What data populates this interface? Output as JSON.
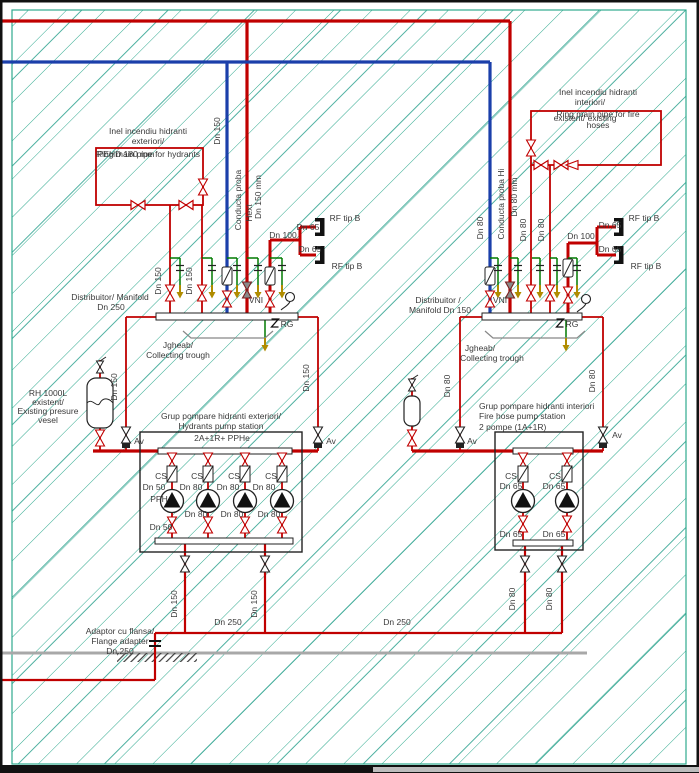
{
  "drawing": {
    "type": "fire-protection-piping-schematic",
    "colors": {
      "pipe_red": "#c00000",
      "pipe_blue": "#1b3faa",
      "hatch_teal": "#2fa98e",
      "drain_green": "#007a00",
      "arrow_olive": "#b08c00",
      "wall_gray": "#a8a8a8",
      "symbol_black": "#222222",
      "text": "#3a3a3a"
    },
    "labels": [
      {
        "n": "ring-ext-title-ro",
        "t": "Inel incendiu hidranti",
        "x": 148,
        "y": 134
      },
      {
        "n": "ring-ext-title-ro2",
        "t": "exteriori/",
        "x": 148,
        "y": 144
      },
      {
        "n": "ring-ext-pehd",
        "t": "PEHD 180 mm",
        "x": 126,
        "y": 157
      },
      {
        "n": "ring-ext-title-en",
        "t": "Ring main pipe for hydrants",
        "x": 148,
        "y": 157
      },
      {
        "n": "dn150-blue-left",
        "t": "Dn 150",
        "x": 220,
        "y": 131,
        "r": -90
      },
      {
        "n": "conducta-proba-left",
        "t": "Conducta proba",
        "x": 241,
        "y": 200,
        "r": -90
      },
      {
        "n": "conducta-proba-left2",
        "t": "Hext",
        "x": 252,
        "y": 213,
        "r": -90
      },
      {
        "n": "dn150mm-left",
        "t": "Dn 150 mm",
        "x": 261,
        "y": 197,
        "r": -90
      },
      {
        "n": "dn100-left",
        "t": "Dn 100",
        "x": 283,
        "y": 238
      },
      {
        "n": "dn65-left-1",
        "t": "Dn 65",
        "x": 308,
        "y": 230
      },
      {
        "n": "rf-left-1",
        "t": "RF tip B",
        "x": 345,
        "y": 221
      },
      {
        "n": "dn65-left-2",
        "t": "Dn 65",
        "x": 310,
        "y": 252
      },
      {
        "n": "rf-left-2",
        "t": "RF tip B",
        "x": 347,
        "y": 269
      },
      {
        "n": "dn150-riser1",
        "t": "Dn 150",
        "x": 161,
        "y": 281,
        "r": -90
      },
      {
        "n": "dn150-riser2",
        "t": "Dn 150",
        "x": 192,
        "y": 281,
        "r": -90
      },
      {
        "n": "manifold-left-1",
        "t": "Distribuitor/ Manifold",
        "x": 110,
        "y": 300
      },
      {
        "n": "manifold-left-2",
        "t": "Dn 250",
        "x": 111,
        "y": 310
      },
      {
        "n": "vni-left",
        "t": "VNI",
        "x": 256,
        "y": 303
      },
      {
        "n": "rg-left",
        "t": "RG",
        "x": 287,
        "y": 327
      },
      {
        "n": "trough-left-ro",
        "t": "Jgheab/",
        "x": 178,
        "y": 348
      },
      {
        "n": "trough-left-en",
        "t": "Collecting trough",
        "x": 178,
        "y": 358
      },
      {
        "n": "vessel-1",
        "t": "RH 1000L",
        "x": 48,
        "y": 396
      },
      {
        "n": "vessel-2",
        "t": "existent/",
        "x": 48,
        "y": 405
      },
      {
        "n": "vessel-3",
        "t": "Existing presure",
        "x": 48,
        "y": 414
      },
      {
        "n": "vessel-4",
        "t": "vesel",
        "x": 48,
        "y": 423
      },
      {
        "n": "dn150-vessel",
        "t": "Dn 150",
        "x": 117,
        "y": 387,
        "r": -90
      },
      {
        "n": "av-1",
        "t": "Av",
        "x": 139,
        "y": 444
      },
      {
        "n": "dn150-right-drop",
        "t": "Dn 150",
        "x": 309,
        "y": 378,
        "r": -90
      },
      {
        "n": "av-2",
        "t": "Av",
        "x": 331,
        "y": 444
      },
      {
        "n": "pump-left-title1",
        "t": "Grup pompare hidranti exteriori/",
        "x": 221,
        "y": 419
      },
      {
        "n": "pump-left-title2",
        "t": "Hydrants pump station",
        "x": 221,
        "y": 429
      },
      {
        "n": "pump-left-title3",
        "t": "2A+1R+ PPHe",
        "x": 222,
        "y": 441
      },
      {
        "n": "cs-1",
        "t": "CS",
        "x": 161,
        "y": 479
      },
      {
        "n": "cs-2",
        "t": "CS",
        "x": 197,
        "y": 479
      },
      {
        "n": "cs-3",
        "t": "CS",
        "x": 234,
        "y": 479
      },
      {
        "n": "cs-4",
        "t": "CS",
        "x": 271,
        "y": 479
      },
      {
        "n": "dn50-1",
        "t": "Dn 50",
        "x": 154,
        "y": 490
      },
      {
        "n": "dn80-1",
        "t": "Dn 80",
        "x": 191,
        "y": 490
      },
      {
        "n": "dn80-2",
        "t": "Dn 80",
        "x": 228,
        "y": 490
      },
      {
        "n": "dn80-3",
        "t": "Dn 80",
        "x": 264,
        "y": 490
      },
      {
        "n": "pph",
        "t": "PPH",
        "x": 159,
        "y": 502
      },
      {
        "n": "dn80-4",
        "t": "Dn 80",
        "x": 196,
        "y": 517
      },
      {
        "n": "dn80-5",
        "t": "Dn 80",
        "x": 232,
        "y": 517
      },
      {
        "n": "dn80-6",
        "t": "Dn 80",
        "x": 269,
        "y": 517
      },
      {
        "n": "dn50-2",
        "t": "Dn 50",
        "x": 161,
        "y": 530
      },
      {
        "n": "dn150-bottom1",
        "t": "Dn 150",
        "x": 177,
        "y": 604,
        "r": -90
      },
      {
        "n": "dn150-bottom2",
        "t": "Dn 150",
        "x": 257,
        "y": 604,
        "r": -90
      },
      {
        "n": "dn250-bottom1",
        "t": "Dn 250",
        "x": 228,
        "y": 625
      },
      {
        "n": "dn250-bottom2",
        "t": "Dn 250",
        "x": 397,
        "y": 625
      },
      {
        "n": "flange-1",
        "t": "Adaptor cu flansa/",
        "x": 120,
        "y": 634
      },
      {
        "n": "flange-2",
        "t": "Flange adapter",
        "x": 120,
        "y": 644
      },
      {
        "n": "flange-3",
        "t": "Dn 250",
        "x": 120,
        "y": 654
      },
      {
        "n": "ring-int-1",
        "t": "Inel incendiu hidranti",
        "x": 598,
        "y": 95
      },
      {
        "n": "ring-int-2",
        "t": "interiori/",
        "x": 590,
        "y": 105
      },
      {
        "n": "ring-int-3",
        "t": "Ring main pipe for fire",
        "x": 598,
        "y": 117
      },
      {
        "n": "ring-int-4",
        "t": "existent/ existing",
        "x": 585,
        "y": 121
      },
      {
        "n": "ring-int-5",
        "t": "hoses",
        "x": 598,
        "y": 128
      },
      {
        "n": "dn80-blue-right",
        "t": "Dn 80",
        "x": 483,
        "y": 228,
        "r": -90
      },
      {
        "n": "conducta-proba-right",
        "t": "Conducta proba Hi",
        "x": 504,
        "y": 204,
        "r": -90
      },
      {
        "n": "dn80mm-right",
        "t": "Dn 80 mm",
        "x": 517,
        "y": 197,
        "r": -90
      },
      {
        "n": "dn80-riser1",
        "t": "Dn 80",
        "x": 526,
        "y": 230,
        "r": -90
      },
      {
        "n": "dn80-riser2",
        "t": "Dn 80",
        "x": 544,
        "y": 230,
        "r": -90
      },
      {
        "n": "dn100-right",
        "t": "Dn 100",
        "x": 581,
        "y": 239
      },
      {
        "n": "dn65-right-1",
        "t": "Dn 65",
        "x": 610,
        "y": 228
      },
      {
        "n": "rf-right-1",
        "t": "RF tip B",
        "x": 644,
        "y": 221
      },
      {
        "n": "dn65-right-2",
        "t": "Dn 65",
        "x": 610,
        "y": 252
      },
      {
        "n": "rf-right-2",
        "t": "RF tip B",
        "x": 646,
        "y": 269
      },
      {
        "n": "manifold-right-1",
        "t": "Distribuitor /",
        "x": 438,
        "y": 303
      },
      {
        "n": "manifold-right-2",
        "t": "Manifold Dn 150",
        "x": 440,
        "y": 313
      },
      {
        "n": "vni-right",
        "t": "VNI",
        "x": 500,
        "y": 303
      },
      {
        "n": "rg-right",
        "t": "RG",
        "x": 572,
        "y": 327
      },
      {
        "n": "trough-right-ro",
        "t": "Jgheab/",
        "x": 480,
        "y": 351
      },
      {
        "n": "trough-right-en",
        "t": "Collecting trough",
        "x": 492,
        "y": 361
      },
      {
        "n": "dn80-tank",
        "t": "Dn 80",
        "x": 450,
        "y": 386,
        "r": -90
      },
      {
        "n": "av-3",
        "t": "Av",
        "x": 472,
        "y": 444
      },
      {
        "n": "av-4",
        "t": "Av",
        "x": 617,
        "y": 438
      },
      {
        "n": "dn80-right-drop",
        "t": "Dn 80",
        "x": 595,
        "y": 381,
        "r": -90
      },
      {
        "n": "pump-right-title1",
        "t": "Grup pompare hidranti interiori",
        "x": 479,
        "y": 409,
        "a": "start"
      },
      {
        "n": "pump-right-title2",
        "t": "Fire hose pump station",
        "x": 479,
        "y": 419,
        "a": "start"
      },
      {
        "n": "pump-right-title3",
        "t": "2 pompe (1A+1R)",
        "x": 479,
        "y": 430,
        "a": "start"
      },
      {
        "n": "cs-5",
        "t": "CS",
        "x": 511,
        "y": 479
      },
      {
        "n": "cs-6",
        "t": "CS",
        "x": 555,
        "y": 479
      },
      {
        "n": "dn65-p1",
        "t": "Dn 65",
        "x": 511,
        "y": 489
      },
      {
        "n": "dn65-p2",
        "t": "Dn 65",
        "x": 554,
        "y": 489
      },
      {
        "n": "dn65-p3",
        "t": "Dn 65",
        "x": 511,
        "y": 537
      },
      {
        "n": "dn65-p4",
        "t": "Dn 65",
        "x": 554,
        "y": 537
      },
      {
        "n": "dn80-bottom1",
        "t": "Dn 80",
        "x": 515,
        "y": 599,
        "r": -90
      },
      {
        "n": "dn80-bottom2",
        "t": "Dn 80",
        "x": 552,
        "y": 599,
        "r": -90
      }
    ]
  }
}
